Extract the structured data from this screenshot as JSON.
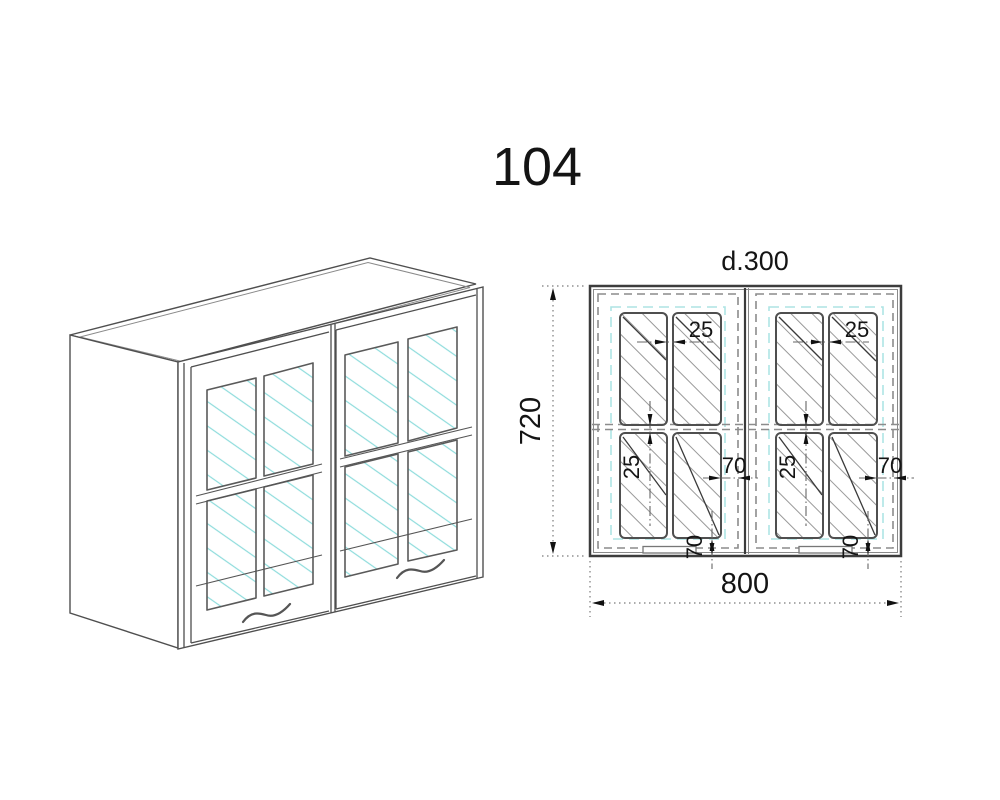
{
  "title": "104",
  "views": {
    "left": "isometric-view",
    "right": "front-elevation-view"
  },
  "dimensions": {
    "depth_label": "d.300",
    "height": "720",
    "width": "800",
    "pane_gap": "25",
    "edge_offset": "70"
  },
  "colors": {
    "line": "#3c3c3c",
    "dashed_door_outline": "#8c8c8c",
    "dashed_glass_frame": "#aee4e4",
    "glass_reflection": "#8edcdc",
    "hatch_gray": "#999999",
    "background": "#ffffff"
  }
}
